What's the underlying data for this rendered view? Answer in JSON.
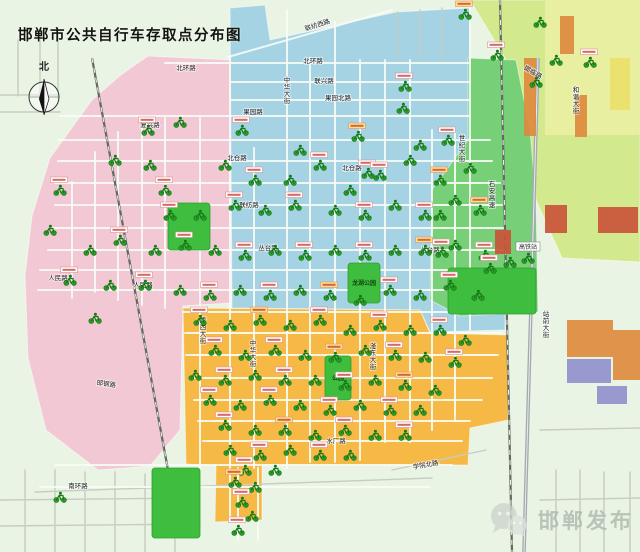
{
  "title": "邯郸市公共自行车存取点分布图",
  "compass": {
    "label": "北"
  },
  "watermark": {
    "icon": "wechat-icon",
    "text": "邯郸发布"
  },
  "colors": {
    "base": "#e9f4e4",
    "zone_pink": "#f2c8d4",
    "zone_blue": "#a5d3e4",
    "zone_orange": "#f6b946",
    "zone_green": "#77cf78",
    "zone_yellowgreen": "#d3e98e",
    "park": "#3ebd3e",
    "road_city": "#f8fcf6",
    "road_outer": "#c6cdc2",
    "rail": "#62695f",
    "highway": "#a2a9b0",
    "station_icon": "#157a15",
    "label_chip_border": "#d98f8f",
    "label_chip_text": "#c9443f"
  },
  "zones": [
    {
      "name": "yellowgreen-northeast",
      "color": "#d3e98e",
      "points": "470,0 640,0 640,262 562,258 536,200 528,118 505,58"
    },
    {
      "name": "pink-west",
      "color": "#f2c8d4",
      "points": "148,56 232,60 231,303 183,306 180,430 150,466 98,470 46,430 28,358 25,276 32,216 50,158 92,100 122,74"
    },
    {
      "name": "blue-north",
      "color": "#a5d3e4",
      "points": "230,8 265,5 270,40 396,12 470,8 472,140 505,160 505,330 430,332 420,310 232,308"
    },
    {
      "name": "green-east",
      "color": "#77cf78",
      "points": "468,58 516,60 530,130 536,200 538,312 460,316 430,300 432,190 468,140"
    },
    {
      "name": "orange-south",
      "color": "#f6b946",
      "points": "183,308 420,310 430,333 508,335 508,420 470,428 468,465 262,465 262,520 215,522 216,466 186,464"
    }
  ],
  "roads": {
    "city": [
      [
        200,
        118,
        200,
        468
      ],
      [
        230,
        58,
        230,
        520
      ],
      [
        254,
        148,
        254,
        468
      ],
      [
        287,
        10,
        287,
        468
      ],
      [
        310,
        58,
        310,
        462
      ],
      [
        335,
        22,
        335,
        462
      ],
      [
        360,
        60,
        360,
        460
      ],
      [
        385,
        60,
        385,
        442
      ],
      [
        410,
        60,
        410,
        442
      ],
      [
        432,
        130,
        432,
        430
      ],
      [
        455,
        132,
        455,
        420
      ],
      [
        470,
        8,
        470,
        330
      ],
      [
        165,
        118,
        165,
        308
      ],
      [
        142,
        120,
        142,
        305
      ],
      [
        118,
        132,
        118,
        300
      ],
      [
        95,
        152,
        95,
        292
      ],
      [
        72,
        182,
        72,
        298
      ],
      [
        165,
        63,
        470,
        63
      ],
      [
        230,
        82,
        470,
        82
      ],
      [
        230,
        100,
        470,
        100
      ],
      [
        60,
        116,
        470,
        116
      ],
      [
        58,
        140,
        490,
        140
      ],
      [
        58,
        161,
        492,
        161
      ],
      [
        55,
        183,
        500,
        183
      ],
      [
        55,
        205,
        502,
        205
      ],
      [
        50,
        228,
        505,
        228
      ],
      [
        48,
        250,
        505,
        250
      ],
      [
        40,
        270,
        505,
        270
      ],
      [
        38,
        290,
        505,
        290
      ],
      [
        183,
        312,
        505,
        312
      ],
      [
        185,
        333,
        502,
        333
      ],
      [
        186,
        355,
        498,
        355
      ],
      [
        190,
        378,
        492,
        378
      ],
      [
        194,
        400,
        482,
        400
      ],
      [
        198,
        421,
        470,
        421
      ],
      [
        203,
        441,
        462,
        441
      ],
      [
        55,
        465,
        452,
        465
      ],
      [
        40,
        487,
        430,
        487
      ],
      [
        228,
        57,
        392,
        10
      ],
      [
        238,
        468,
        238,
        540
      ],
      [
        258,
        468,
        258,
        540
      ]
    ],
    "outer": [
      [
        0,
        95,
        58,
        95
      ],
      [
        18,
        40,
        18,
        96
      ],
      [
        40,
        28,
        40,
        96
      ],
      [
        58,
        34,
        58,
        100
      ],
      [
        0,
        112,
        60,
        112
      ],
      [
        398,
        12,
        398,
        58
      ],
      [
        420,
        10,
        420,
        58
      ],
      [
        442,
        8,
        442,
        58
      ],
      [
        25,
        470,
        25,
        552
      ],
      [
        55,
        470,
        55,
        552
      ],
      [
        85,
        472,
        85,
        552
      ],
      [
        115,
        472,
        115,
        552
      ],
      [
        145,
        474,
        145,
        552
      ],
      [
        175,
        476,
        175,
        552
      ],
      [
        0,
        500,
        198,
        498
      ],
      [
        0,
        526,
        200,
        524
      ],
      [
        556,
        470,
        556,
        552
      ],
      [
        580,
        470,
        580,
        552
      ],
      [
        604,
        472,
        604,
        552
      ],
      [
        630,
        472,
        630,
        552
      ],
      [
        540,
        500,
        640,
        498
      ],
      [
        540,
        430,
        640,
        428
      ],
      [
        392,
        470,
        486,
        450
      ],
      [
        35,
        492,
        432,
        478
      ]
    ],
    "rails": [
      [
        92,
        58,
        168,
        470
      ],
      [
        500,
        0,
        512,
        552
      ]
    ],
    "highway": [
      [
        538,
        58,
        524,
        552
      ]
    ]
  },
  "parks": [
    {
      "name": "congtai-park",
      "x": 168,
      "y": 203,
      "w": 42,
      "h": 47,
      "label": ""
    },
    {
      "name": "longhu-park",
      "x": 348,
      "y": 263,
      "w": 32,
      "h": 40,
      "label": "龙湖公园"
    },
    {
      "name": "fuyang-park",
      "x": 325,
      "y": 356,
      "w": 26,
      "h": 44,
      "label": "公园"
    },
    {
      "name": "south-park",
      "x": 152,
      "y": 468,
      "w": 48,
      "h": 70,
      "label": ""
    },
    {
      "name": "east-green",
      "x": 448,
      "y": 268,
      "w": 88,
      "h": 46,
      "label": ""
    }
  ],
  "buildings": [
    [
      545,
      0,
      95,
      135,
      "#e9efa3"
    ],
    [
      560,
      16,
      14,
      38,
      "#dd8a3e"
    ],
    [
      524,
      58,
      12,
      78,
      "#dd8a3e"
    ],
    [
      575,
      95,
      12,
      42,
      "#dd8a3e"
    ],
    [
      610,
      58,
      20,
      52,
      "#eadf6a"
    ],
    [
      545,
      205,
      22,
      28,
      "#c9543a"
    ],
    [
      598,
      207,
      40,
      26,
      "#c9543a"
    ],
    [
      495,
      230,
      16,
      24,
      "#c9543a"
    ],
    [
      567,
      320,
      46,
      37,
      "#dd8a3e"
    ],
    [
      613,
      330,
      27,
      50,
      "#dd8a3e"
    ],
    [
      567,
      359,
      44,
      24,
      "#9090cc"
    ],
    [
      597,
      386,
      30,
      18,
      "#9090cc"
    ]
  ],
  "streets": [
    {
      "t": "北环路",
      "x": 186,
      "y": 70
    },
    {
      "t": "北环路",
      "x": 313,
      "y": 63
    },
    {
      "t": "联兴路",
      "x": 324,
      "y": 83
    },
    {
      "t": "果园北路",
      "x": 338,
      "y": 100
    },
    {
      "t": "果园路",
      "x": 253,
      "y": 114
    },
    {
      "t": "复兴路",
      "x": 150,
      "y": 127
    },
    {
      "t": "北仓路",
      "x": 237,
      "y": 160
    },
    {
      "t": "北仓路",
      "x": 352,
      "y": 170
    },
    {
      "t": "联纺路",
      "x": 249,
      "y": 207
    },
    {
      "t": "丛台路",
      "x": 268,
      "y": 250
    },
    {
      "t": "丛台路",
      "x": 430,
      "y": 252
    },
    {
      "t": "人民路",
      "x": 58,
      "y": 280
    },
    {
      "t": "人民路",
      "x": 143,
      "y": 287
    },
    {
      "t": "邯钢路",
      "x": 106,
      "y": 386,
      "r": 8
    },
    {
      "t": "水厂路",
      "x": 336,
      "y": 443
    },
    {
      "t": "南环路",
      "x": 78,
      "y": 488
    },
    {
      "t": "学院北路",
      "x": 426,
      "y": 467,
      "r": -10
    },
    {
      "t": "联纺西路",
      "x": 318,
      "y": 27,
      "r": -18
    },
    {
      "t": "邯临路",
      "x": 532,
      "y": 74,
      "r": 30
    },
    {
      "t": "中华大街",
      "x": 287,
      "y": 82,
      "v": 1
    },
    {
      "t": "中华大街",
      "x": 253,
      "y": 345,
      "v": 1
    },
    {
      "t": "陵西大街",
      "x": 203,
      "y": 322,
      "v": 1
    },
    {
      "t": "滏东大街",
      "x": 373,
      "y": 348,
      "v": 1
    },
    {
      "t": "世纪大街",
      "x": 462,
      "y": 140,
      "v": 1
    },
    {
      "t": "站前大街",
      "x": 546,
      "y": 316,
      "v": 1
    },
    {
      "t": "和谐大街",
      "x": 576,
      "y": 92,
      "v": 1
    },
    {
      "t": "石安高速",
      "x": 492,
      "y": 186,
      "v": 1
    }
  ],
  "pois": [
    {
      "t": "高铁站",
      "x": 516,
      "y": 242
    }
  ],
  "stations": [
    [
      465,
      14
    ],
    [
      540,
      22
    ],
    [
      497,
      55
    ],
    [
      556,
      60
    ],
    [
      590,
      62
    ],
    [
      536,
      82
    ],
    [
      405,
      86
    ],
    [
      403,
      108
    ],
    [
      368,
      173
    ],
    [
      180,
      122
    ],
    [
      242,
      130
    ],
    [
      300,
      150
    ],
    [
      358,
      136
    ],
    [
      420,
      145
    ],
    [
      448,
      140
    ],
    [
      150,
      165
    ],
    [
      165,
      190
    ],
    [
      225,
      165
    ],
    [
      255,
      180
    ],
    [
      290,
      180
    ],
    [
      320,
      165
    ],
    [
      350,
      190
    ],
    [
      380,
      175
    ],
    [
      410,
      160
    ],
    [
      440,
      180
    ],
    [
      470,
      168
    ],
    [
      295,
      205
    ],
    [
      265,
      210
    ],
    [
      235,
      205
    ],
    [
      200,
      215
    ],
    [
      170,
      215
    ],
    [
      335,
      210
    ],
    [
      365,
      215
    ],
    [
      395,
      205
    ],
    [
      425,
      215
    ],
    [
      455,
      200
    ],
    [
      480,
      210
    ],
    [
      90,
      250
    ],
    [
      120,
      240
    ],
    [
      155,
      250
    ],
    [
      185,
      245
    ],
    [
      215,
      250
    ],
    [
      245,
      255
    ],
    [
      275,
      250
    ],
    [
      305,
      255
    ],
    [
      335,
      250
    ],
    [
      365,
      255
    ],
    [
      395,
      250
    ],
    [
      425,
      250
    ],
    [
      455,
      245
    ],
    [
      485,
      255
    ],
    [
      510,
      262
    ],
    [
      70,
      280
    ],
    [
      110,
      285
    ],
    [
      145,
      285
    ],
    [
      180,
      290
    ],
    [
      210,
      295
    ],
    [
      240,
      290
    ],
    [
      270,
      295
    ],
    [
      300,
      290
    ],
    [
      330,
      295
    ],
    [
      360,
      300
    ],
    [
      390,
      290
    ],
    [
      420,
      295
    ],
    [
      450,
      285
    ],
    [
      478,
      295
    ],
    [
      60,
      190
    ],
    [
      50,
      230
    ],
    [
      148,
      130
    ],
    [
      115,
      160
    ],
    [
      200,
      320
    ],
    [
      230,
      325
    ],
    [
      260,
      320
    ],
    [
      290,
      325
    ],
    [
      320,
      320
    ],
    [
      350,
      330
    ],
    [
      380,
      325
    ],
    [
      410,
      330
    ],
    [
      440,
      330
    ],
    [
      465,
      340
    ],
    [
      215,
      350
    ],
    [
      245,
      355
    ],
    [
      275,
      350
    ],
    [
      305,
      355
    ],
    [
      335,
      357
    ],
    [
      365,
      350
    ],
    [
      395,
      355
    ],
    [
      425,
      357
    ],
    [
      455,
      362
    ],
    [
      195,
      375
    ],
    [
      225,
      380
    ],
    [
      255,
      375
    ],
    [
      285,
      380
    ],
    [
      315,
      380
    ],
    [
      345,
      385
    ],
    [
      375,
      380
    ],
    [
      405,
      385
    ],
    [
      435,
      390
    ],
    [
      210,
      400
    ],
    [
      240,
      405
    ],
    [
      270,
      400
    ],
    [
      300,
      405
    ],
    [
      330,
      410
    ],
    [
      360,
      405
    ],
    [
      390,
      410
    ],
    [
      420,
      410
    ],
    [
      225,
      425
    ],
    [
      255,
      430
    ],
    [
      285,
      430
    ],
    [
      315,
      435
    ],
    [
      345,
      430
    ],
    [
      375,
      435
    ],
    [
      405,
      435
    ],
    [
      230,
      450
    ],
    [
      260,
      455
    ],
    [
      290,
      450
    ],
    [
      320,
      455
    ],
    [
      350,
      455
    ],
    [
      245,
      470
    ],
    [
      275,
      470
    ],
    [
      235,
      482
    ],
    [
      255,
      487
    ],
    [
      242,
      502
    ],
    [
      252,
      516
    ],
    [
      238,
      530
    ],
    [
      60,
      497
    ],
    [
      528,
      258
    ],
    [
      95,
      318
    ],
    [
      490,
      268
    ],
    [
      440,
      215
    ],
    [
      442,
      252
    ]
  ]
}
